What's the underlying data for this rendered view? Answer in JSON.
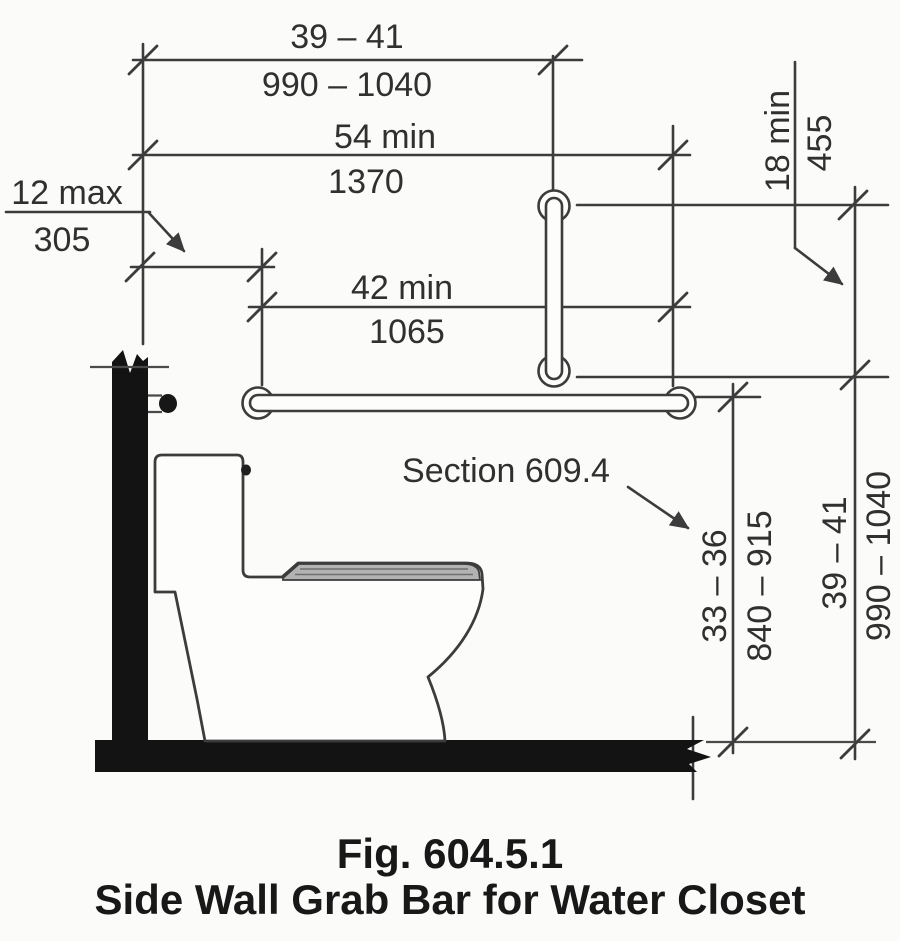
{
  "figure": {
    "caption": {
      "line1": "Fig. 604.5.1",
      "line2": "Side Wall Grab Bar for Water Closet"
    },
    "reference_note": "Section 609.4",
    "dimensions": {
      "vertical_bar_centerline_from_rear_wall": {
        "inches": "39 – 41",
        "mm": "990 – 1040"
      },
      "bar_extent_from_rear_wall": {
        "inches": "54 min",
        "mm": "1370"
      },
      "bar_start_from_rear_wall": {
        "inches": "12 max",
        "mm": "305"
      },
      "side_bar_length": {
        "inches": "42 min",
        "mm": "1065"
      },
      "vertical_bar_length": {
        "inches": "18 min",
        "mm": "455"
      },
      "side_bar_height_above_floor": {
        "inches": "33 – 36",
        "mm": "840 – 915"
      },
      "vertical_bar_lower_end_height": {
        "inches": "39 – 41",
        "mm": "990 – 1040"
      }
    },
    "colors": {
      "line": "#3c3c3c",
      "solid_wall_floor": "#131313",
      "background": "#fbfbf9",
      "seat_fill": "#b3b3b3"
    }
  }
}
